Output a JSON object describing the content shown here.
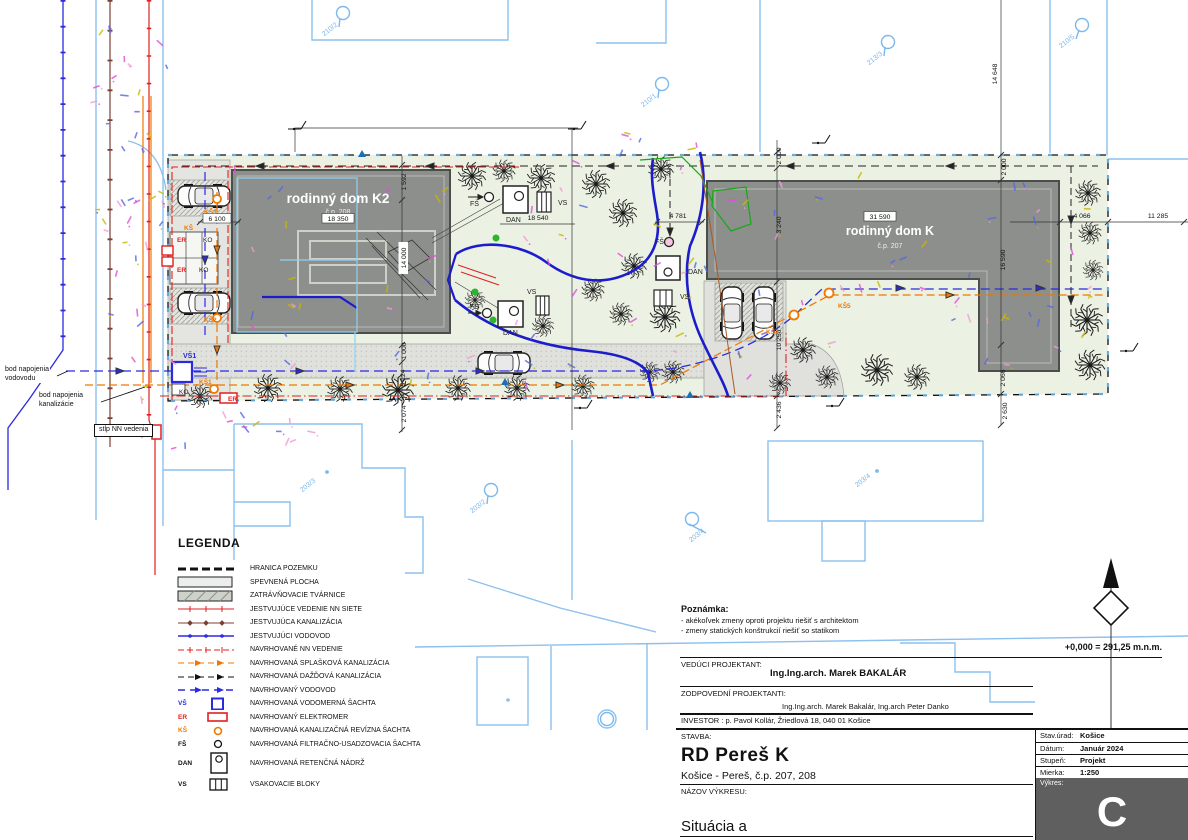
{
  "plan": {
    "houses": [
      {
        "name": "rodinný dom K2",
        "cp": "č.p. 208"
      },
      {
        "name": "rodinný dom K",
        "cp": "č.p. 207"
      }
    ],
    "callouts": [
      {
        "text": "bod napojenia\nvodovodu"
      },
      {
        "text": "bod napojenia\nkanalizácie"
      },
      {
        "text": "stĺp NN vedenia"
      }
    ],
    "dimensions": [
      {
        "t": "14 648",
        "x": 997,
        "y": 74,
        "r": -90
      },
      {
        "t": "11 285",
        "x": 1158,
        "y": 218
      },
      {
        "t": "4 066",
        "x": 1082,
        "y": 218
      },
      {
        "t": "2 000",
        "x": 1006,
        "y": 167,
        "r": -90
      },
      {
        "t": "16 590",
        "x": 1005,
        "y": 260,
        "r": -90
      },
      {
        "t": "2 066",
        "x": 1005,
        "y": 378,
        "r": -90
      },
      {
        "t": "2 630",
        "x": 1007,
        "y": 411,
        "r": -90
      },
      {
        "t": "2 000",
        "x": 781,
        "y": 156,
        "r": -90
      },
      {
        "t": "3 240",
        "x": 781,
        "y": 225,
        "r": -90
      },
      {
        "t": "10 250",
        "x": 781,
        "y": 340,
        "r": -90
      },
      {
        "t": "2 436",
        "x": 781,
        "y": 410,
        "r": -90
      },
      {
        "t": "4 781",
        "x": 678,
        "y": 218
      },
      {
        "t": "18 540",
        "x": 538,
        "y": 220
      },
      {
        "t": "1 592",
        "x": 406,
        "y": 182,
        "r": -90
      },
      {
        "t": "14 000",
        "x": 406,
        "y": 258,
        "r": -90,
        "box": true
      },
      {
        "t": "1 000",
        "x": 406,
        "y": 351,
        "r": -90
      },
      {
        "t": "5 124",
        "x": 405,
        "y": 378,
        "r": -90
      },
      {
        "t": "2 074",
        "x": 406,
        "y": 414,
        "r": -90
      },
      {
        "t": "6 100",
        "x": 217,
        "y": 221,
        "box": true,
        "border": true
      },
      {
        "t": "18 350",
        "x": 338,
        "y": 221,
        "box": true,
        "border": true
      },
      {
        "t": "31 590",
        "x": 880,
        "y": 219,
        "box": true,
        "border": true
      }
    ],
    "labels": [
      {
        "t": "VŠ1",
        "x": 183,
        "y": 358,
        "c": "blue",
        "fs": 7
      },
      {
        "t": "KO",
        "x": 179,
        "y": 394,
        "c": "black",
        "fs": 6.5
      },
      {
        "t": "KŠ1",
        "x": 199,
        "y": 384,
        "c": "orange",
        "fs": 6.5
      },
      {
        "t": "ER",
        "x": 228,
        "y": 401,
        "c": "red",
        "fs": 6.5
      },
      {
        "t": "KŠ3",
        "x": 204,
        "y": 214,
        "c": "orange",
        "fs": 6.5
      },
      {
        "t": "KŠ2",
        "x": 204,
        "y": 322,
        "c": "orange",
        "fs": 6.5
      },
      {
        "t": "KŠ",
        "x": 184,
        "y": 230,
        "c": "orange",
        "fs": 6.5
      },
      {
        "t": "ER",
        "x": 177,
        "y": 242,
        "c": "red",
        "fs": 6.5
      },
      {
        "t": "KO",
        "x": 203,
        "y": 242,
        "c": "black",
        "fs": 6.5
      },
      {
        "t": "ER",
        "x": 177,
        "y": 272,
        "c": "red",
        "fs": 6.5
      },
      {
        "t": "KO",
        "x": 199,
        "y": 272,
        "c": "black",
        "fs": 6.5
      },
      {
        "t": "FŠ",
        "x": 470,
        "y": 206,
        "c": "black",
        "fs": 7
      },
      {
        "t": "DAN",
        "x": 506,
        "y": 222,
        "c": "black",
        "fs": 7
      },
      {
        "t": "VS",
        "x": 558,
        "y": 205,
        "c": "black",
        "fs": 7
      },
      {
        "t": "FŠ",
        "x": 470,
        "y": 309,
        "c": "black",
        "fs": 7
      },
      {
        "t": "DAN",
        "x": 503,
        "y": 335,
        "c": "black",
        "fs": 7
      },
      {
        "t": "VS",
        "x": 527,
        "y": 294,
        "c": "black",
        "fs": 7
      },
      {
        "t": "FŠ",
        "x": 655,
        "y": 244,
        "c": "black",
        "fs": 7
      },
      {
        "t": "DAN",
        "x": 688,
        "y": 274,
        "c": "black",
        "fs": 7
      },
      {
        "t": "VS",
        "x": 680,
        "y": 299,
        "c": "black",
        "fs": 7
      },
      {
        "t": "KŠ4",
        "x": 766,
        "y": 334,
        "c": "orange",
        "fs": 6.5
      },
      {
        "t": "KŠ5",
        "x": 838,
        "y": 308,
        "c": "orange",
        "fs": 6.5
      }
    ],
    "parcels": [
      {
        "t": "210/2",
        "x": 331,
        "y": 31,
        "lx": 343,
        "ly": 13
      },
      {
        "t": "213/3",
        "x": 876,
        "y": 60,
        "lx": 888,
        "ly": 42
      },
      {
        "t": "210/1",
        "x": 650,
        "y": 102,
        "lx": 662,
        "ly": 84
      },
      {
        "t": "210/5",
        "x": 1068,
        "y": 43,
        "lx": 1082,
        "ly": 25
      },
      {
        "t": "203/3",
        "x": 309,
        "y": 487,
        "dx": 327,
        "dy": 472
      },
      {
        "t": "203/2",
        "x": 479,
        "y": 508,
        "lx": 491,
        "ly": 490
      },
      {
        "t": "203/4",
        "x": 698,
        "y": 537,
        "lx": 692,
        "ly": 519
      },
      {
        "t": "203/4",
        "x": 864,
        "y": 482,
        "dx": 877,
        "dy": 471
      },
      {
        "t": "",
        "x": 607,
        "y": 719,
        "lx": 607,
        "ly": 719
      }
    ]
  },
  "legend": {
    "title": "LEGENDA",
    "items": [
      {
        "label": "HRANICA POZEMKU"
      },
      {
        "label": "SPEVNENÁ PLOCHA"
      },
      {
        "label": "ZATRÁVŇOVACIE TVÁRNICE"
      },
      {
        "label": "JESTVUJÚCE VEDENIE NN SIETE"
      },
      {
        "label": "JESTVUJÚCA KANALIZÁCIA"
      },
      {
        "label": "JESTVUJÚCI VODOVOD"
      },
      {
        "label": "NAVRHOVANÉ NN VEDENIE"
      },
      {
        "label": "NAVRHOVANÁ SPLAŠKOVÁ KANALIZÁCIA"
      },
      {
        "label": "NAVRHOVANÁ DAŽĎOVÁ KANALIZÁCIA"
      },
      {
        "label": "NAVRHOVANÝ VODOVOD"
      },
      {
        "prefix": "VŠ",
        "label": "NAVRHOVANÁ VODOMERNÁ ŠACHTA"
      },
      {
        "prefix": "ER",
        "label": "NAVRHOVANÝ ELEKTROMER"
      },
      {
        "prefix": "KŠ",
        "label": "NAVRHOVANÁ KANALIZAČNÁ REVÍZNA ŠACHTA"
      },
      {
        "prefix": "FŠ",
        "label": "NAVRHOVANÁ FILTRAČNO-USADZOVACIA ŠACHTA"
      },
      {
        "prefix": "DAN",
        "label": "NAVRHOVANÁ RETENČNÁ NÁDRŽ"
      },
      {
        "prefix": "VS",
        "label": "VSAKOVACIE BLOKY"
      }
    ]
  },
  "note": {
    "title": "Poznámka:",
    "lines": [
      "- akékoľvek zmeny oproti projektu riešiť s architektom",
      "- zmeny statických konštrukcií riešiť so statikom"
    ]
  },
  "elevation_note": "+0,000 = 291,25 m.n.m.",
  "titleblock": {
    "lead_label": "VEDÚCI PROJEKTANT:",
    "lead_name": "Ing.Ing.arch. Marek BAKALÁR",
    "resp_label": "ZODPOVEDNÍ PROJEKTANTI:",
    "resp_names": "Ing.Ing.arch. Marek Bakalár, Ing.arch Peter Danko",
    "investor": "INVESTOR :  p. Pavol Kollár, Žriedlová 18, 040 01 Košice",
    "stavba_label": "STAVBA:",
    "project": "RD Pereš K",
    "project_sub": "Košice - Pereš, č.p. 207, 208",
    "nazov_label": "NÁZOV VÝKRESU:",
    "drawing_title": "Situácia a",
    "table": [
      {
        "label": "Stav.úrad:",
        "value": "Košice"
      },
      {
        "label": "Dátum:",
        "value": "Január 2024"
      },
      {
        "label": "Stupeň:",
        "value": "Projekt"
      },
      {
        "label": "Mierka:",
        "value": "1:250"
      }
    ],
    "vykres_label": "Výkres:",
    "vykres_letter": "C"
  },
  "colors": {
    "water_existing": "#2a2ae0",
    "water_thick": "#1c1ccd",
    "sewer_existing": "#7b4036",
    "nn_red": "#e02020",
    "sewage_orange": "#f07800",
    "cadastre_blue": "#8cc0ee",
    "plot_green": "#ebf1e3",
    "house_gray": "#8d8f8c"
  }
}
